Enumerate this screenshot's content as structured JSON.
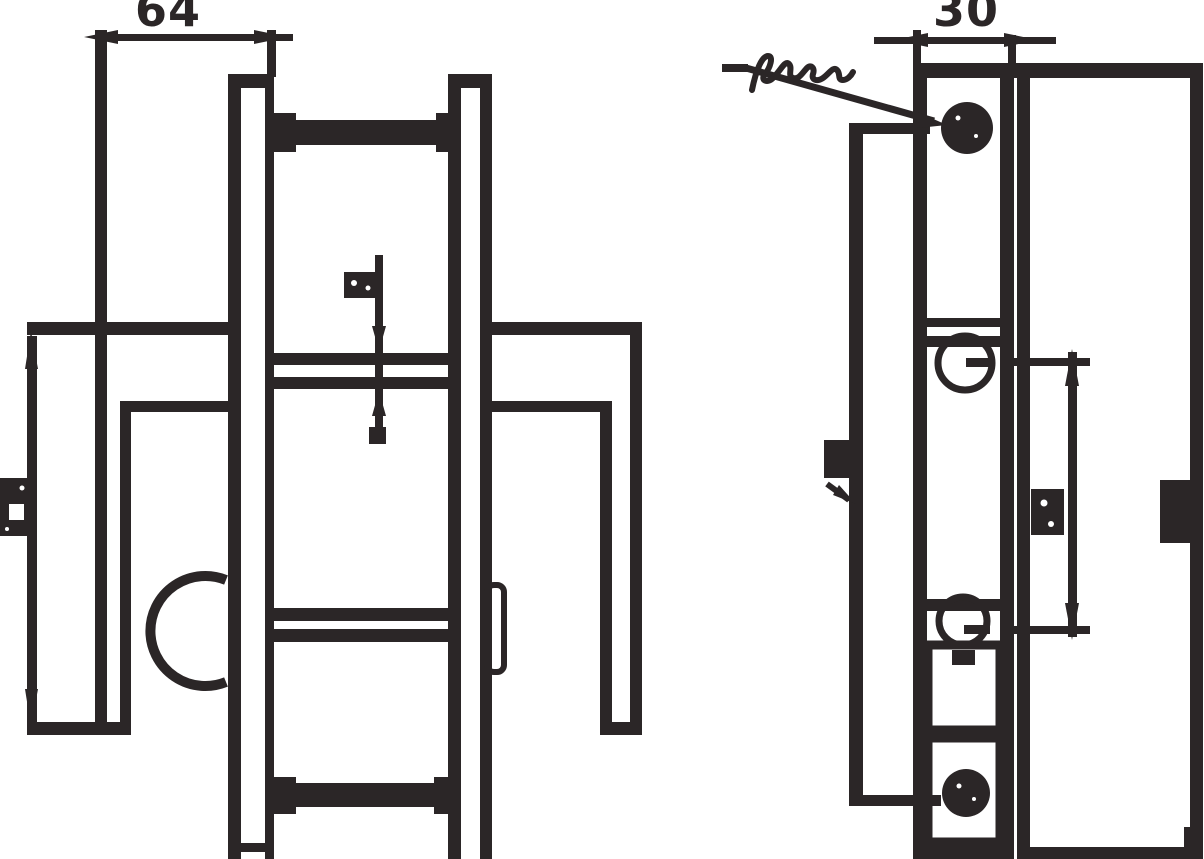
{
  "document": {
    "kind": "technical-line-drawing",
    "description": "Two orthographic views of a door lock / handle assembly drawn in dark ink on white",
    "ink_color": "#2b2627",
    "background_color": "#ffffff"
  },
  "views": {
    "front": {
      "label": "front-view",
      "dimensions": {
        "top_width": {
          "text": "64",
          "clipped_top": true
        },
        "height": {
          "illegible": true,
          "rotated": true,
          "clipped_left": true
        },
        "rail_gap": {
          "illegible": true
        }
      },
      "features": [
        "outer-profile-line",
        "left-mounting-plate",
        "right-mounting-plate",
        "top-crossbar-with-end-tabs",
        "bottom-crossbar-with-end-tabs",
        "upper-rail-pair",
        "lower-rail-pair",
        "handle-arc",
        "left-bracket-arm",
        "right-bracket-arm",
        "right-edge-slot"
      ]
    },
    "side": {
      "label": "side-view",
      "dimensions": {
        "top_depth": {
          "text": "30",
          "clipped_top": true
        },
        "hole_spacing": {
          "illegible": true,
          "rotated": true
        }
      },
      "leader_note": {
        "illegible": true,
        "style": "handwritten-scribble",
        "points_to": "top-screw-head"
      },
      "edge_label": {
        "illegible": true,
        "points_to": "left-edge-line"
      },
      "features": [
        "narrow-faceplate",
        "door-panel",
        "top-screw-head",
        "bottom-screw-head",
        "upper-spindle-hole",
        "lower-spindle-hole",
        "lower-window",
        "lower-screw-window",
        "latch-block"
      ]
    }
  }
}
